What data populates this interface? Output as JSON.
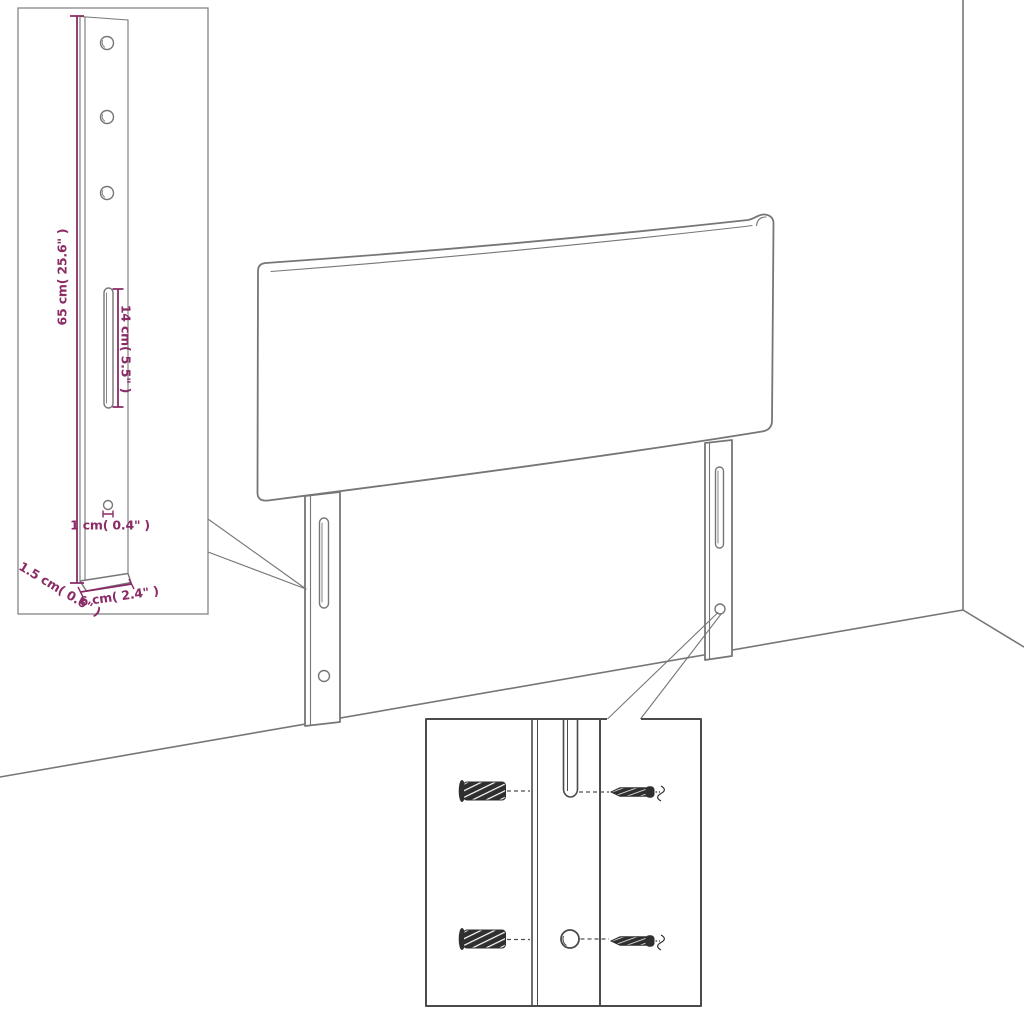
{
  "diagram": {
    "name": "headboard-assembly-dimension-diagram",
    "colors": {
      "line_art": "#767676",
      "inset_border": "#4b4b4b",
      "dimension": "#8a2b66",
      "hardware": "#2f2f2f",
      "background": "#ffffff"
    },
    "bracket_inset": {
      "labels": {
        "height": "65 cm( 25.6\" )",
        "slot_length": "14 cm( 5.5\" )",
        "hole_diameter": "1 cm( 0.4\" )",
        "thickness": "1.5 cm( 0.6\" )",
        "width": "6 cm( 2.4\" )"
      }
    },
    "mounting_inset": {
      "hardware_icons": [
        "wall-plug-icon",
        "screw-icon",
        "wall-plug-icon",
        "screw-icon"
      ]
    }
  }
}
